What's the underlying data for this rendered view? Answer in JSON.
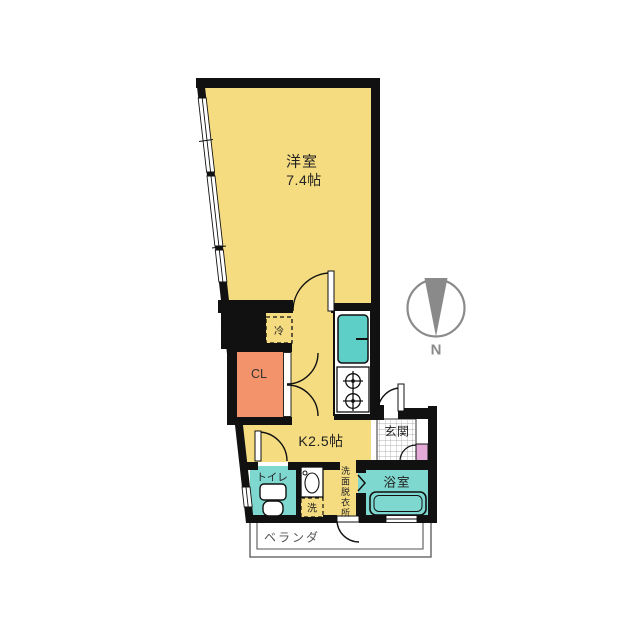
{
  "plan": {
    "western_room": {
      "label": "洋室",
      "size": "7.4帖"
    },
    "kitchen": {
      "label": "K2.5帖"
    },
    "entrance": {
      "label": "玄関"
    },
    "toilet": {
      "label": "トイレ"
    },
    "bathroom": {
      "label": "浴室"
    },
    "washroom": {
      "label": "洗面脱衣所"
    },
    "closet": {
      "label": "CL"
    },
    "veranda": {
      "label": "ベランダ"
    },
    "refrigerator": {
      "label": "冷"
    },
    "washer": {
      "label": "洗"
    },
    "compass": {
      "label": "N",
      "direction": "north-points-down"
    },
    "colors": {
      "room_yellow": "#F5DC80",
      "wet_area_teal": "#7FD8CF",
      "sink_teal": "#5ECFC6",
      "closet_orange": "#F2936B",
      "accent_pink": "#E5ABD8",
      "wall_black": "#111111",
      "compass_gray": "#8A8A8A"
    }
  }
}
